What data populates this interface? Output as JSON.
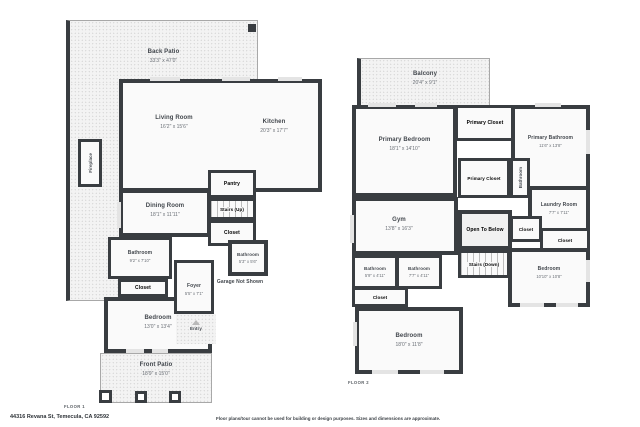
{
  "address": "44316 Revana St, Temecula, CA 92592",
  "disclaimer": "Floor plans/tour cannot be used for building or design purposes. Sizes and dimensions are approximate.",
  "colors": {
    "wall": "#393d41",
    "floor_fill": "#fafafa",
    "patio_fill": "#f3f3f3",
    "text": "#42474d"
  },
  "floor1": {
    "label": "FLOOR 1",
    "rooms": {
      "back_patio": {
        "name": "Back Patio",
        "dims": "33'3\" x 47'0\""
      },
      "living_room": {
        "name": "Living Room",
        "dims": "16'2\" x 15'6\""
      },
      "kitchen": {
        "name": "Kitchen",
        "dims": "20'3\" x 17'7\""
      },
      "fireplace": {
        "name": "Fireplace"
      },
      "dining_room": {
        "name": "Dining Room",
        "dims": "18'1\" x 11'11\""
      },
      "pantry": {
        "name": "Pantry"
      },
      "stairs_up": {
        "name": "Stairs (Up)"
      },
      "closet_hall": {
        "name": "Closet"
      },
      "bathroom_left": {
        "name": "Bathroom",
        "dims": "9'2\" x 7'10\""
      },
      "closet_bedroom": {
        "name": "Closet"
      },
      "bedroom": {
        "name": "Bedroom",
        "dims": "13'0\" x 13'4\""
      },
      "foyer": {
        "name": "Foyer",
        "dims": "5'5\" x 7'1\""
      },
      "bathroom_small": {
        "name": "Bathroom",
        "dims": "5'3\" x 5'6\""
      },
      "garage": {
        "name": "Garage Not Shown"
      },
      "entry": {
        "name": "Entry"
      },
      "front_patio": {
        "name": "Front Patio",
        "dims": "18'9\" x 15'0\""
      }
    }
  },
  "floor2": {
    "label": "FLOOR 2",
    "rooms": {
      "balcony": {
        "name": "Balcony",
        "dims": "20'4\" x 9'1\""
      },
      "primary_bedroom": {
        "name": "Primary Bedroom",
        "dims": "18'1\" x 14'10\""
      },
      "primary_closet_1": {
        "name": "Primary Closet"
      },
      "primary_bathroom": {
        "name": "Primary Bathroom",
        "dims": "11'6\" x 13'8\""
      },
      "primary_closet_2": {
        "name": "Primary Closet"
      },
      "bathroom_hall": {
        "name": "Bathroom"
      },
      "laundry_room": {
        "name": "Laundry Room",
        "dims": "7'7\" x 7'11\""
      },
      "gym": {
        "name": "Gym",
        "dims": "13'8\" x 16'3\""
      },
      "open_to_below": {
        "name": "Open To Below"
      },
      "closet_a": {
        "name": "Closet"
      },
      "closet_b": {
        "name": "Closet"
      },
      "stairs_down": {
        "name": "Stairs (Down)"
      },
      "bathroom_a": {
        "name": "Bathroom",
        "dims": "5'9\" x 4'11\""
      },
      "bathroom_b": {
        "name": "Bathroom",
        "dims": "7'7\" x 4'11\""
      },
      "bedroom_right": {
        "name": "Bedroom",
        "dims": "10'10\" x 10'8\""
      },
      "closet_c": {
        "name": "Closet"
      },
      "bedroom_bottom": {
        "name": "Bedroom",
        "dims": "18'0\" x 11'8\""
      }
    }
  }
}
